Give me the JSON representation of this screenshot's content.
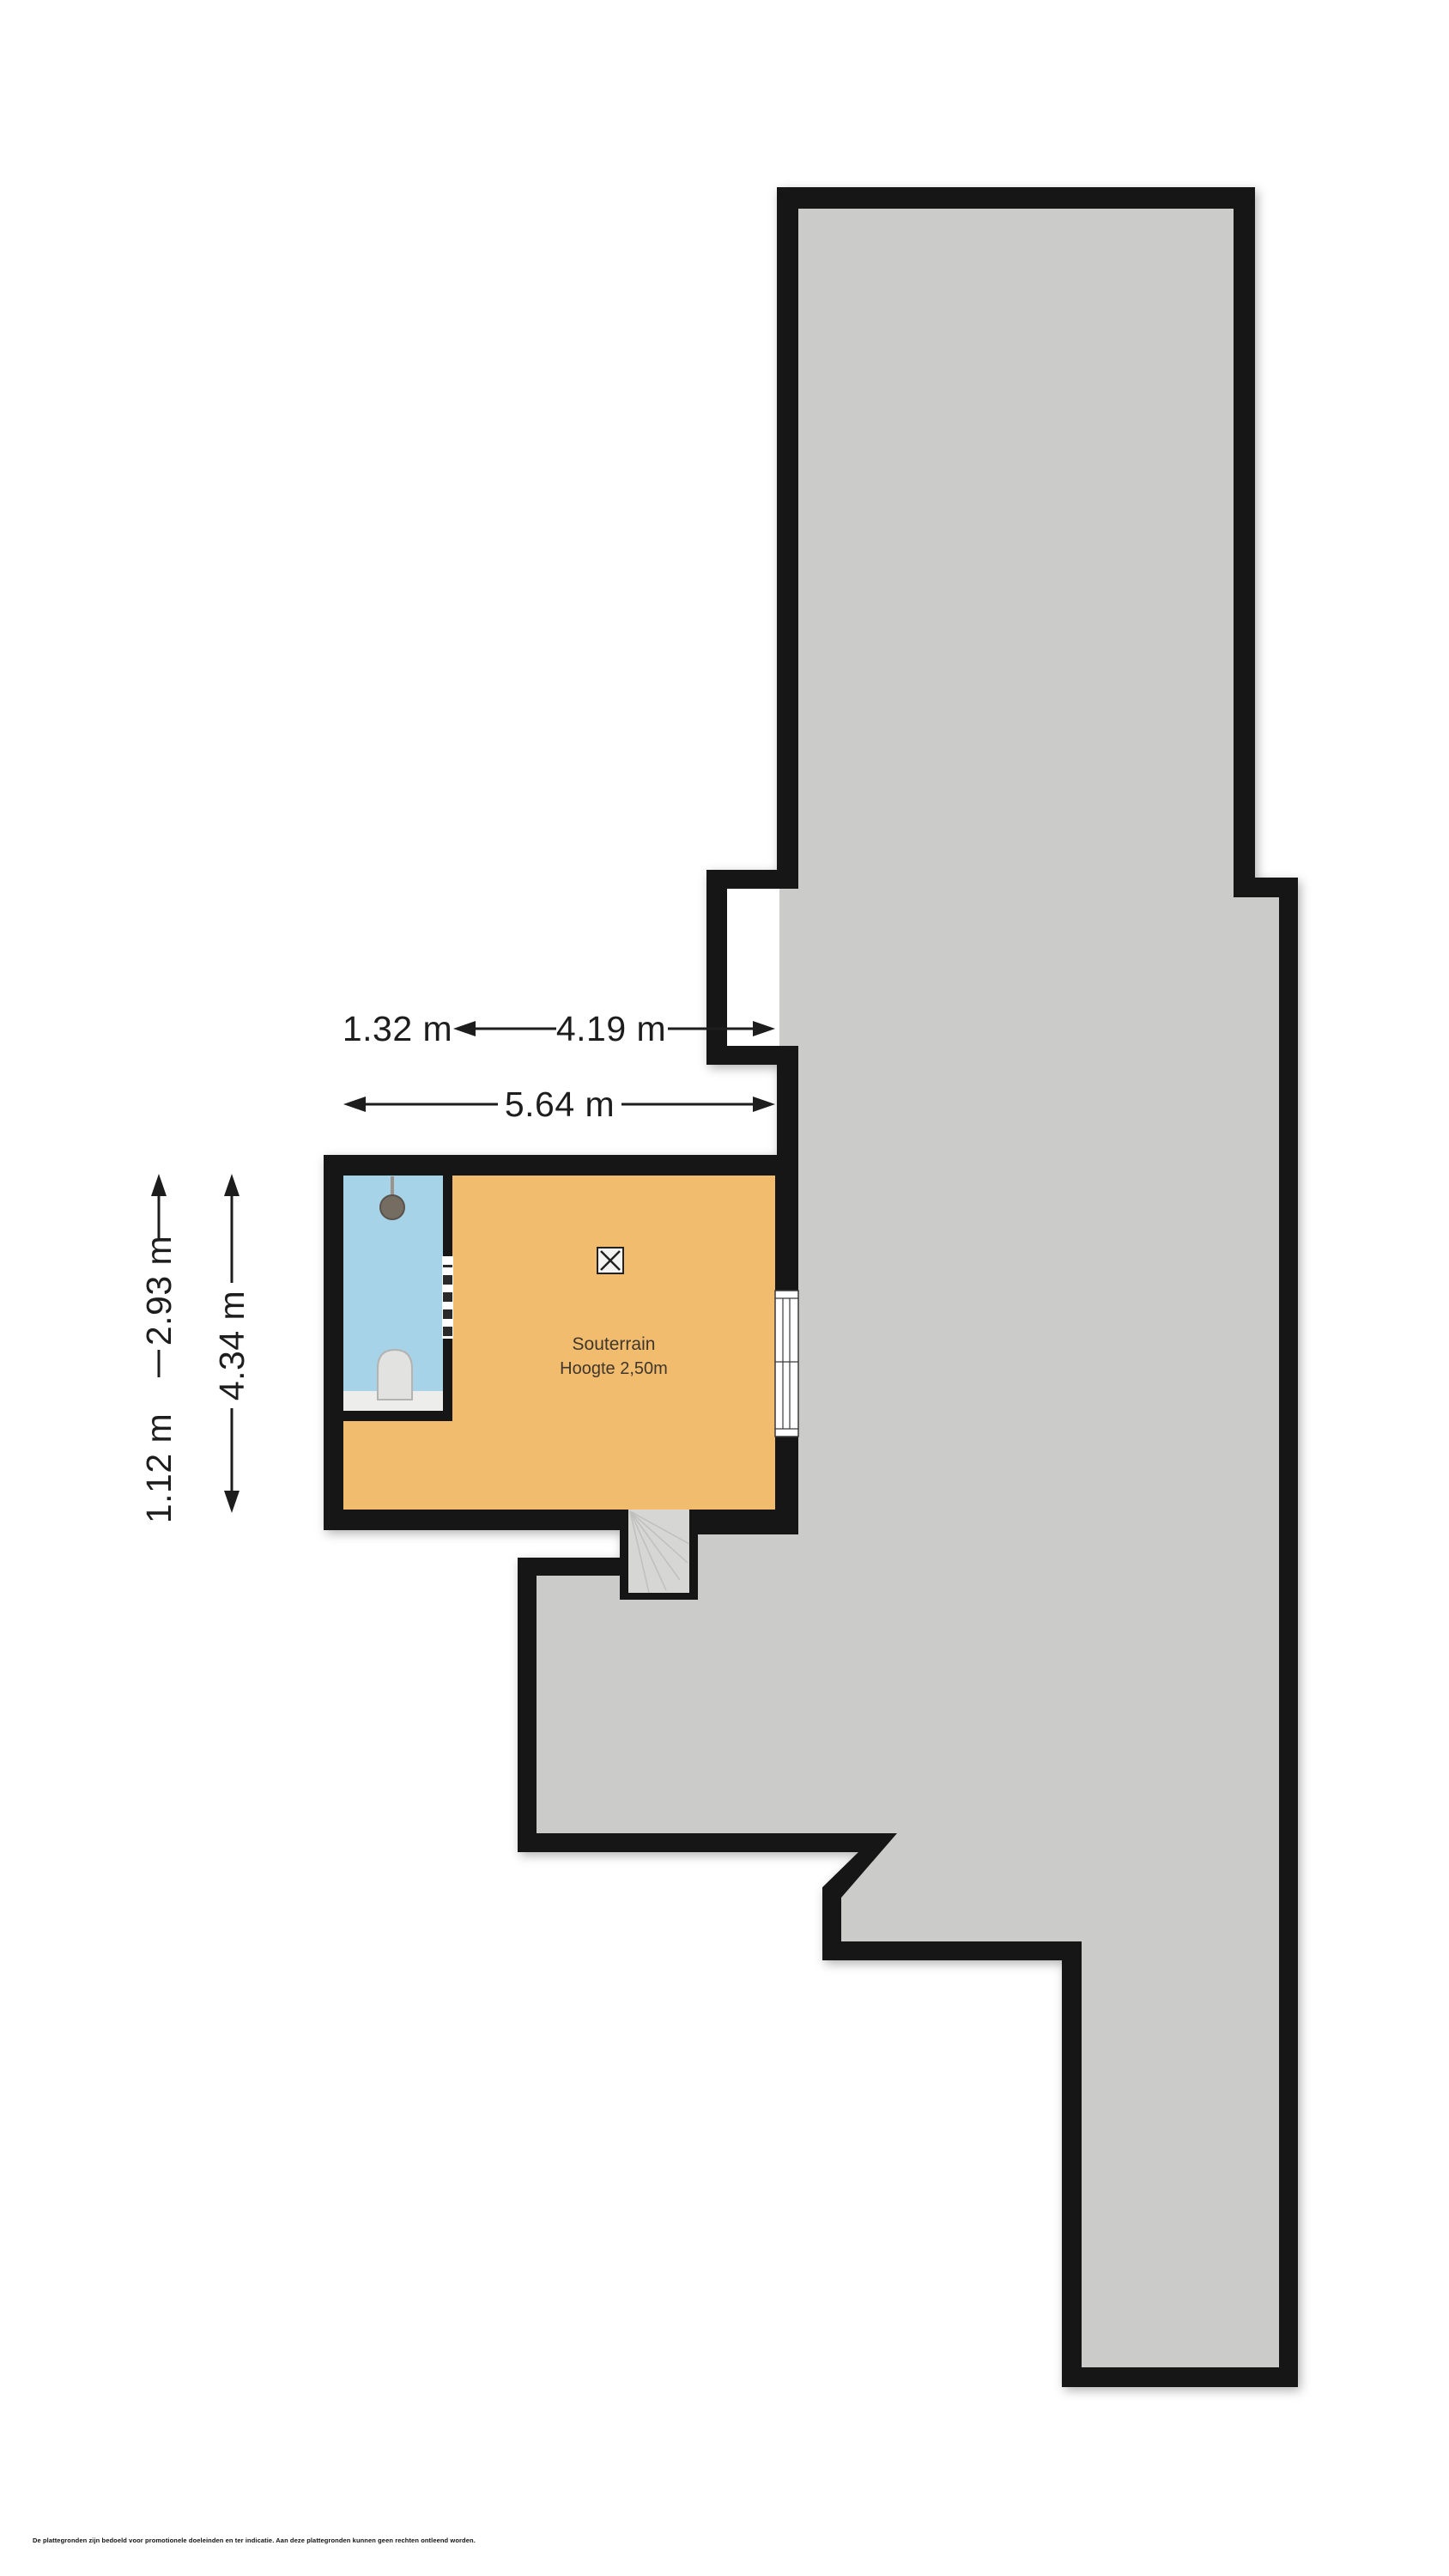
{
  "floorplan": {
    "room": {
      "label": "Souterrain",
      "height_label": "Hoogte 2,50m"
    },
    "dimensions": {
      "width_bathroom": "1.32 m",
      "width_room": "4.19 m",
      "width_total": "5.64 m",
      "height_bathroom": "2.93 m",
      "height_lower": "1.12 m",
      "height_total": "4.34 m"
    },
    "colors": {
      "wall": "#161616",
      "other_floor_fill": "#cbcbca",
      "room_floor_fill": "#f2bc6f",
      "bathroom_floor_fill": "#a6d3e8",
      "stairs_fill": "#d6d6d5",
      "counter_fill": "#ededeb",
      "toilet_fill": "#e2e2e0",
      "toilet_stroke": "#b3b3b1",
      "fixture_fill": "#756c62",
      "dimension_color": "#1d1d1d",
      "room_text_color": "#3f362c",
      "window_frame": "#3a3a3a"
    },
    "icons": {
      "light_point": "light-point-icon",
      "washbasin": "washbasin-icon",
      "toilet": "toilet-icon"
    }
  },
  "footer": {
    "disclaimer": "De plattegronden zijn bedoeld voor promotionele doeleinden en ter indicatie. Aan deze plattegronden kunnen geen rechten ontleend worden."
  }
}
